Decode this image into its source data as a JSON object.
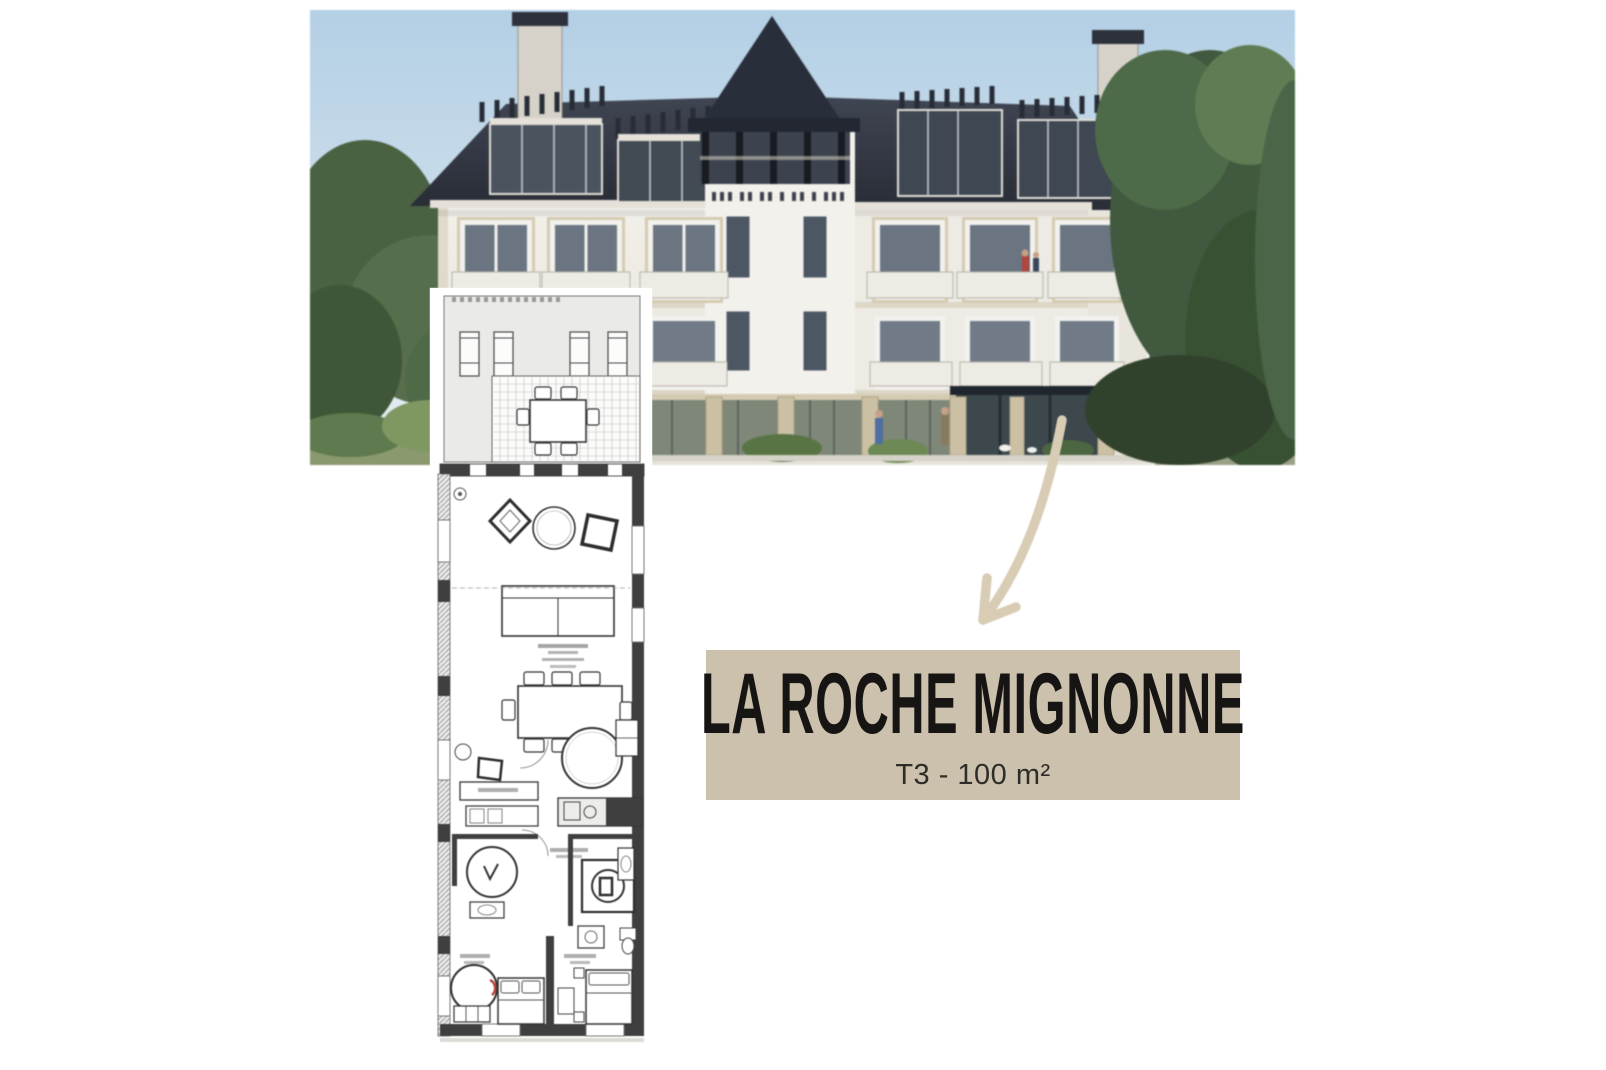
{
  "banner": {
    "title": "LA ROCHE MIGNONNE",
    "subtitle": "T3 - 100 m²"
  },
  "icons": {
    "arrow": "curved-arrow-pointing-to-floor-plan"
  },
  "colors": {
    "banner-bg": "#ccc1ad",
    "banner-title": "#171513",
    "banner-subtitle": "#2f2d29",
    "arrow": "#d8ccb4",
    "sky-top": "#b3d2ea",
    "sky-bottom": "#e9f2f8",
    "roof": "#343a47",
    "wall": "#f4f2ec",
    "stone": "#cfc2a3",
    "tree-dark": "#3e583a",
    "tree-light": "#6f8f56",
    "plan-line": "#3a3a3a",
    "plan-terrace": "#eaeae8"
  }
}
